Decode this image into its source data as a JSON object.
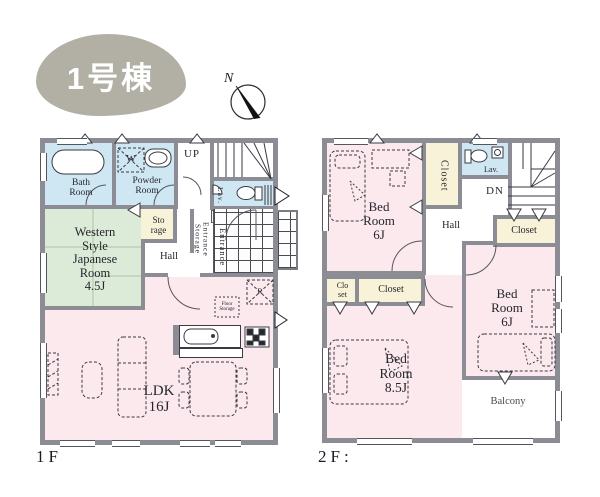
{
  "badge": {
    "label": "1号棟"
  },
  "compass": {
    "north_label": "N"
  },
  "colors": {
    "wall": "#8c8c94",
    "water_rooms": "#cfe7f2",
    "japanese_room": "#dcead8",
    "closets": "#f7f2d8",
    "living_rooms": "#fbe9ee",
    "badge": "#b2b0a5",
    "outline": "#3a3a42"
  },
  "floor1": {
    "label": "1F",
    "rooms": {
      "bath": "Bath\nRoom",
      "powder": "Powder\nRoom",
      "stairs": "UP",
      "lav": "Lav.",
      "storage": "Sto\nrage",
      "western": "Western\nStyle\nJapanese\nRoom\n4.5J",
      "entrance_storage": "Entrance\nStorage",
      "entrance": "Entrance",
      "hall": "Hall",
      "ldk": "LDK\n16J",
      "floor_storage": "Floor\nStorage",
      "fridge": "R",
      "washer": "W"
    }
  },
  "floor2": {
    "label": "2F:",
    "rooms": {
      "bedroom_left": "Bed\nRoom\n6J",
      "closet_top": "Closet",
      "lav": "Lav.",
      "stairs": "DN",
      "hall": "Hall",
      "closet_right": "Closet",
      "closet_small": "Clo\nset",
      "closet_mid": "Closet",
      "bedroom_right": "Bed\nRoom\n6J",
      "bedroom_main": "Bed\nRoom\n8.5J",
      "balcony": "Balcony"
    }
  },
  "icons": {
    "compass": "compass-north-icon",
    "bathtub": "bathtub-icon",
    "washing_machine": "washing-machine-icon",
    "toilet": "toilet-icon",
    "sink": "sink-icon",
    "stove": "gas-stove-icon",
    "refrigerator": "refrigerator-icon",
    "sofa": "sofa-icon",
    "dining_table": "dining-table-icon",
    "bed": "bed-icon",
    "desk": "desk-icon",
    "stairs": "stairs-icon"
  }
}
